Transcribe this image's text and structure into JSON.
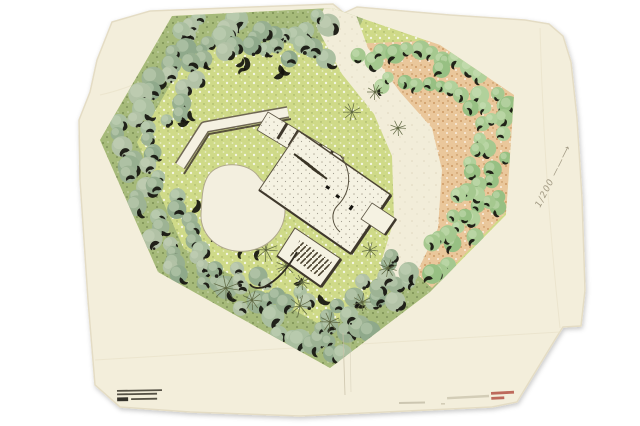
{
  "artwork": {
    "title": "Site plan drawing",
    "annotations": {
      "scale_note": "1/200 ——⟶"
    },
    "stamps": {
      "archive_stamp": {
        "rows": 3,
        "color": "#3a362c"
      },
      "red_stamp": {
        "rows": 2,
        "color": "#b0493c"
      },
      "pencil_notes": {
        "marks": 2,
        "color": "#b3ab94"
      }
    }
  },
  "palette": {
    "page_bg": "#ffffff",
    "paper": "#f3eedb",
    "paper_edge": "#e4dcc4",
    "lawn": "#cfda88",
    "forest_ground": "#a6ba7a",
    "conifers": [
      "#9db394",
      "#aabfa0",
      "#8fa98b",
      "#b2c2a6",
      "#97af90"
    ],
    "conifer_highlight": "#c9d6bd",
    "orchard_ground": "#eac79b",
    "orchard_trees": [
      "#a5c88f",
      "#97c083",
      "#b1d19b"
    ],
    "ink": "#15130e",
    "roof": "#f5f2e2",
    "wall_dark": "#3f382c",
    "pool": "#f3efdf",
    "pool_outline": "#b0a88e",
    "pencil": "#a79f89",
    "stamp_red": "#b0493c",
    "star_tree": "#5d6640"
  }
}
